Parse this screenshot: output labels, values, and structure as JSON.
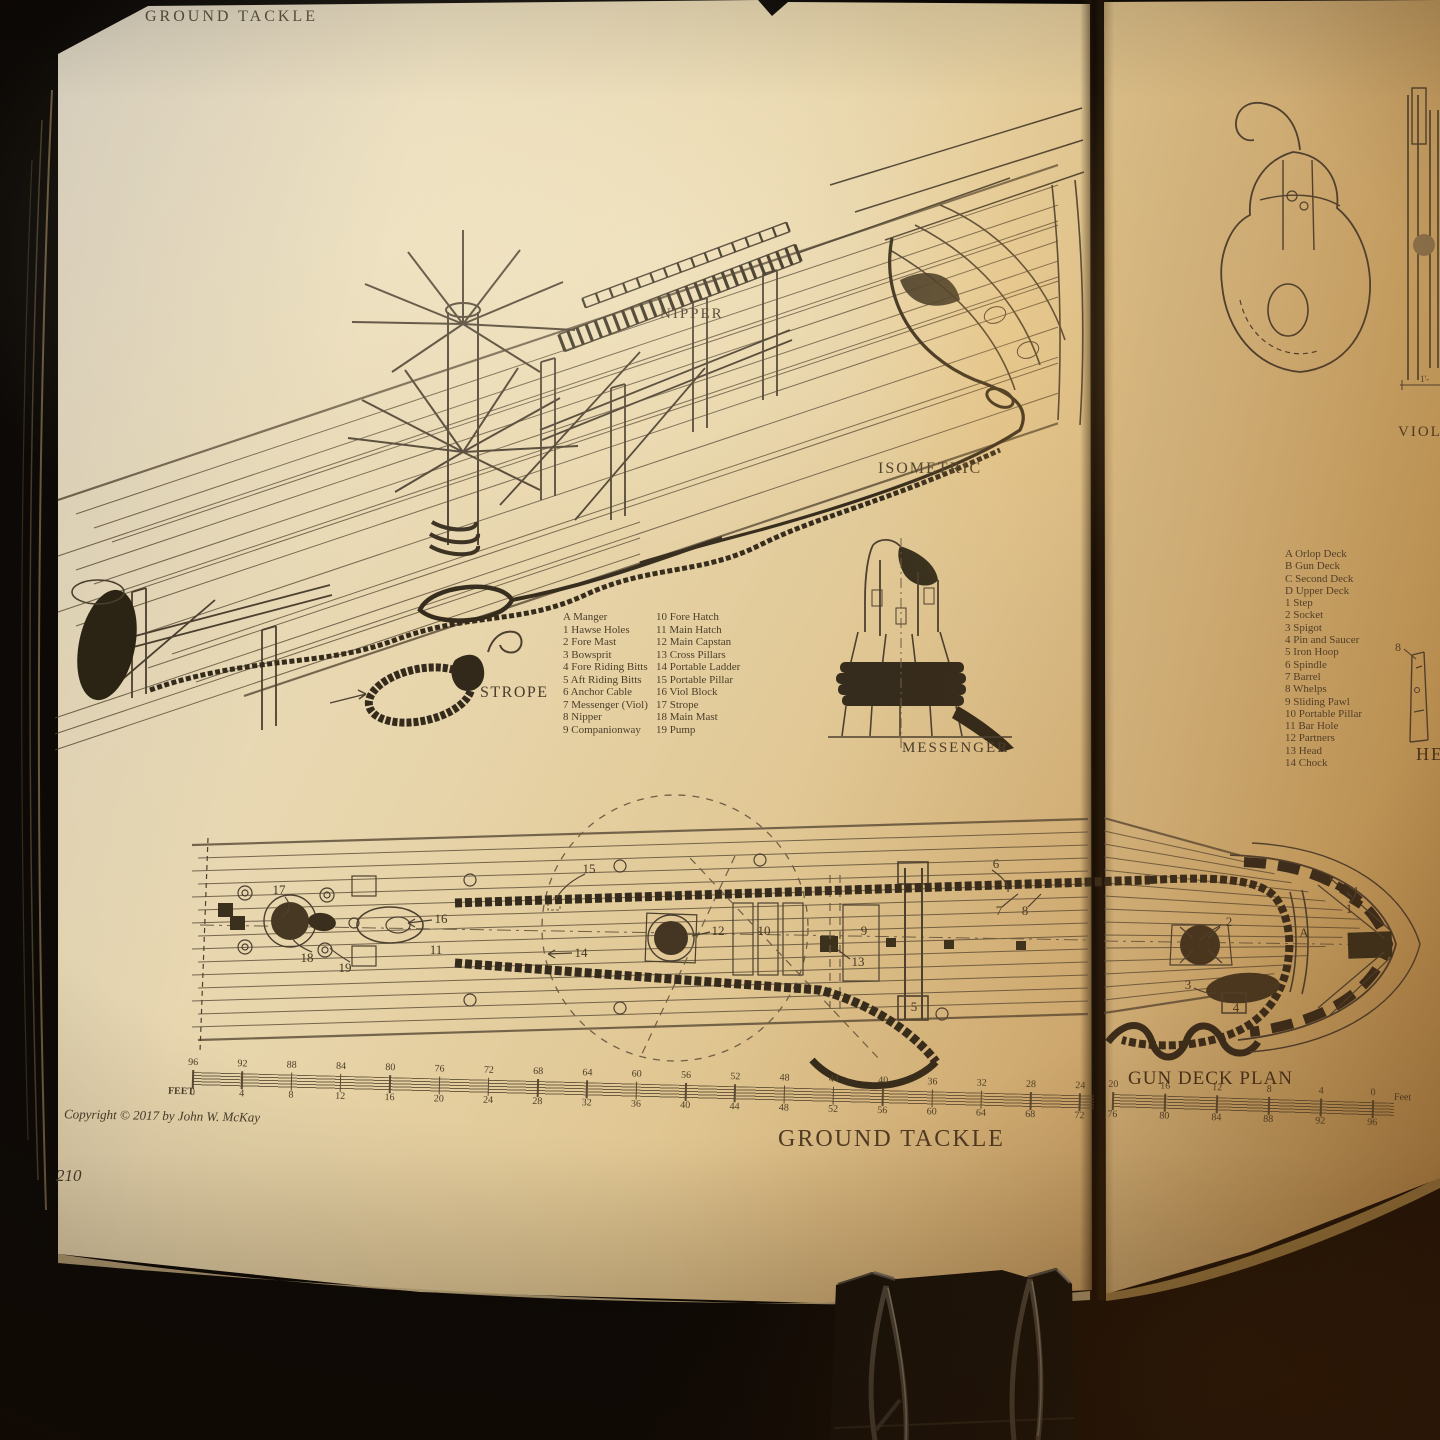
{
  "colors": {
    "paper_light": "#e9dcbd",
    "paper_warm": "#d6b47a",
    "ink": "#4c4030",
    "ink_dark": "#2f2619",
    "background": "#0c0906"
  },
  "left_page": {
    "header": "GROUND TACKLE",
    "figure_title": "GROUND TACKLE",
    "iso_labels": {
      "nipper": "NIPPER",
      "isometric": "ISOMETRIC",
      "strope": "STROPE",
      "messenger": "MESSENGER"
    },
    "legend": {
      "col1": [
        "A Manger",
        "1 Hawse Holes",
        "2 Fore Mast",
        "3 Bowsprit",
        "4 Fore Riding Bitts",
        "5 Aft Riding Bitts",
        "6 Anchor Cable",
        "7 Messenger (Viol)",
        "8 Nipper",
        "9 Companionway"
      ],
      "col2": [
        "10 Fore Hatch",
        "11 Main Hatch",
        "12 Main Capstan",
        "13 Cross Pillars",
        "14 Portable Ladder",
        "15 Portable Pillar",
        "16 Viol Block",
        "17 Strope",
        "18 Main Mast",
        "19 Pump"
      ]
    },
    "plan_annotations": [
      {
        "t": "17",
        "x": 279,
        "y": 890
      },
      {
        "t": "18",
        "x": 307,
        "y": 958
      },
      {
        "t": "19",
        "x": 345,
        "y": 968
      },
      {
        "t": "16",
        "x": 441,
        "y": 919
      },
      {
        "t": "11",
        "x": 436,
        "y": 950
      },
      {
        "t": "14",
        "x": 581,
        "y": 953
      },
      {
        "t": "15",
        "x": 589,
        "y": 869
      },
      {
        "t": "12",
        "x": 718,
        "y": 931
      },
      {
        "t": "10",
        "x": 764,
        "y": 931
      },
      {
        "t": "9",
        "x": 864,
        "y": 931
      },
      {
        "t": "13",
        "x": 858,
        "y": 962
      },
      {
        "t": "5",
        "x": 914,
        "y": 1007
      },
      {
        "t": "6",
        "x": 996,
        "y": 864
      },
      {
        "t": "7",
        "x": 999,
        "y": 911
      },
      {
        "t": "8",
        "x": 1025,
        "y": 911
      }
    ],
    "scale": {
      "unit": "FEET",
      "top": [
        96,
        92,
        88,
        84,
        80,
        76,
        72,
        68,
        64,
        60,
        56,
        52,
        48,
        44,
        40,
        36,
        32,
        28,
        24
      ],
      "bottom": [
        0,
        4,
        8,
        12,
        16,
        20,
        24,
        28,
        32,
        36,
        40,
        44,
        48,
        52,
        56,
        60,
        64,
        68,
        72
      ]
    },
    "copyright": "Copyright © 2017 by John W. McKay",
    "page_number": "210"
  },
  "right_page": {
    "viol_label": "VIOL",
    "head_label": "HE",
    "whelp_callout": "8",
    "dimension_label": "1'-",
    "plan_title": "GUN DECK PLAN",
    "legend": [
      "A Orlop Deck",
      "B Gun Deck",
      "C Second Deck",
      "D Upper Deck",
      "1 Step",
      "2 Socket",
      "3 Spigot",
      "4 Pin and Saucer",
      "5 Iron Hoop",
      "6 Spindle",
      "7 Barrel",
      "8 Whelps",
      "9 Sliding Pawl",
      "10 Portable Pillar",
      "11 Bar Hole",
      "12 Partners",
      "13 Head",
      "14 Chock"
    ],
    "plan_annotations": [
      {
        "t": "2",
        "x": 1229,
        "y": 922
      },
      {
        "t": "3",
        "x": 1188,
        "y": 985
      },
      {
        "t": "A",
        "x": 1304,
        "y": 933
      },
      {
        "t": "1",
        "x": 1349,
        "y": 909
      },
      {
        "t": "4",
        "x": 1236,
        "y": 1008
      }
    ],
    "scale": {
      "unit": "Feet",
      "top": [
        20,
        16,
        12,
        8,
        4,
        0
      ],
      "bottom": [
        76,
        80,
        84,
        88,
        92,
        96
      ]
    }
  }
}
